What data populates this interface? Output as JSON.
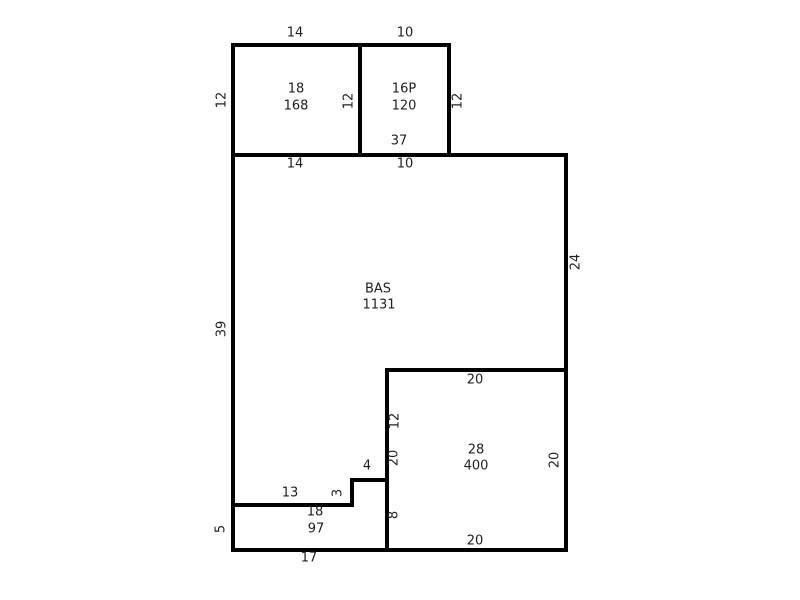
{
  "sketch": {
    "rooms": {
      "top_left": {
        "code": "18",
        "area": "168"
      },
      "top_right": {
        "code": "16P",
        "area": "120"
      },
      "main": {
        "code": "BAS",
        "area": "1131"
      },
      "lower_right": {
        "code": "28",
        "area": "400"
      },
      "bottom_left": {
        "code": "18",
        "area": "97"
      }
    },
    "dims": {
      "top_left_width_top": "14",
      "top_right_width_top": "10",
      "top_left_height_left": "12",
      "divider_height": "12",
      "top_right_height_right": "12",
      "main_width_total": "37",
      "main_width_left_segment": "14",
      "main_width_right_segment": "10",
      "main_height_left": "39",
      "main_height_right": "24",
      "lower_right_width_top": "20",
      "lower_right_left_upper": "12",
      "lower_right_left_full": "20",
      "lower_right_left_lower": "8",
      "lower_right_height_right": "20",
      "lower_right_width_bottom": "20",
      "step_width": "4",
      "step_height": "3",
      "notch_width": "13",
      "bottom_left_height": "5",
      "bottom_left_width": "17"
    },
    "colors": {
      "background": "#ffffff",
      "line": "#000000",
      "text": "#1f1f1f"
    }
  }
}
